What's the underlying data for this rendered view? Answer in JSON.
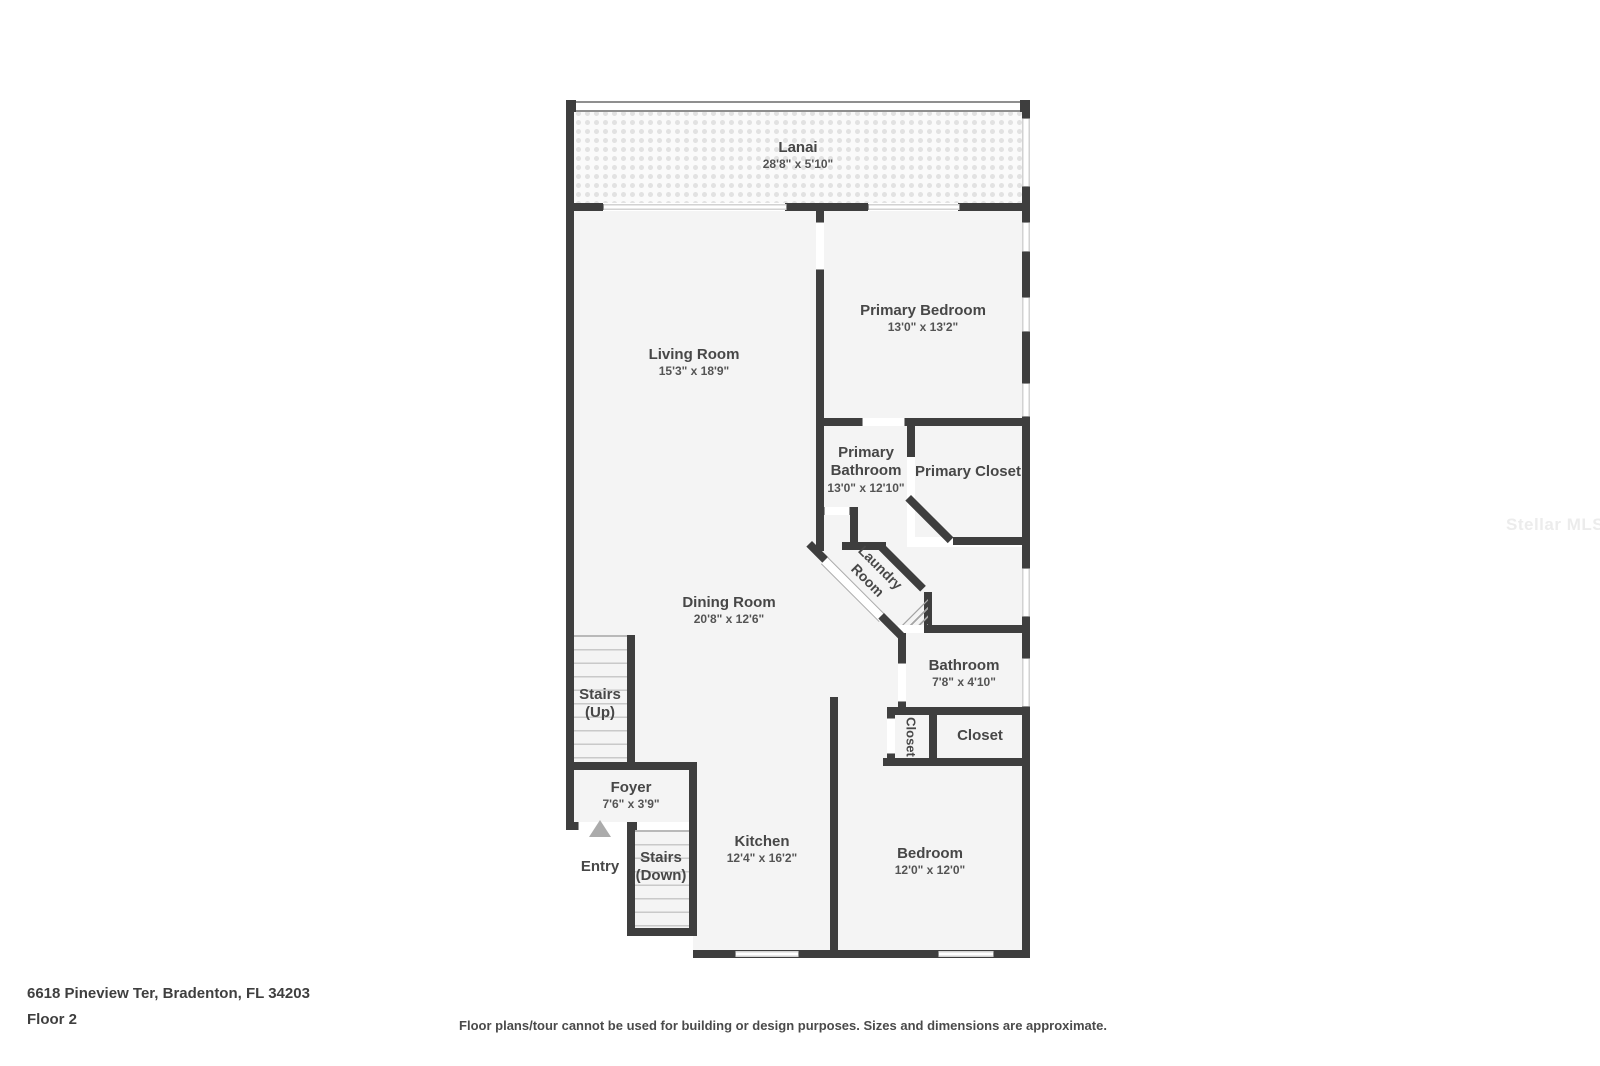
{
  "watermark": "Stellar MLS",
  "colors": {
    "wall": "#3e3e3e",
    "floor": "#f4f4f4"
  },
  "rooms": {
    "lanai": {
      "name": "Lanai",
      "dims": "28'8\" x 5'10\""
    },
    "living": {
      "name": "Living Room",
      "dims": "15'3\" x 18'9\""
    },
    "primary_bedroom": {
      "name": "Primary Bedroom",
      "dims": "13'0\" x 13'2\""
    },
    "primary_bathroom": {
      "name": "Primary Bathroom",
      "dims": "13'0\" x 12'10\""
    },
    "primary_closet": {
      "name": "Primary Closet"
    },
    "laundry": {
      "name": "Laundry Room"
    },
    "dining": {
      "name": "Dining Room",
      "dims": "20'8\" x 12'6\""
    },
    "bathroom": {
      "name": "Bathroom",
      "dims": "7'8\" x 4'10\""
    },
    "closet_small": {
      "name": "Closet"
    },
    "closet": {
      "name": "Closet"
    },
    "stairs_up": {
      "name": "Stairs (Up)"
    },
    "foyer": {
      "name": "Foyer",
      "dims": "7'6\" x 3'9\""
    },
    "entry": {
      "name": "Entry"
    },
    "stairs_down": {
      "name": "Stairs (Down)"
    },
    "kitchen": {
      "name": "Kitchen",
      "dims": "12'4\" x 16'2\""
    },
    "bedroom": {
      "name": "Bedroom",
      "dims": "12'0\" x 12'0\""
    }
  },
  "footer": {
    "address": "6618 Pineview Ter, Bradenton, FL 34203",
    "floor": "Floor 2",
    "disclaimer": "Floor plans/tour cannot be used for building or design purposes. Sizes and dimensions are approximate."
  }
}
